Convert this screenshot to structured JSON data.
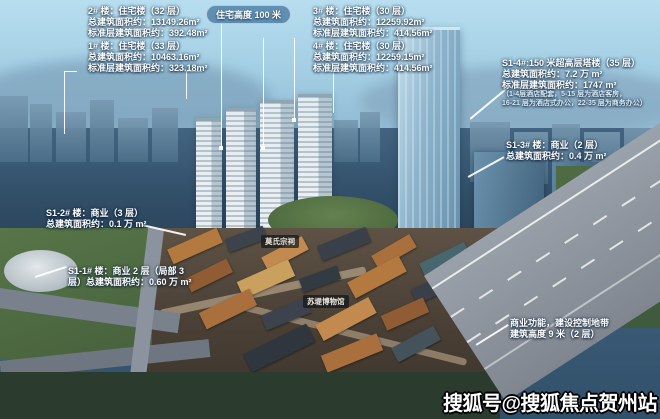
{
  "scene_title": "楼盘鸟瞰效果图（贺州）",
  "height_pill": {
    "text": "住宅高度 100 米"
  },
  "annotations": [
    {
      "id": "building-2",
      "lines": [
        "2# 楼：住宅楼（32 层）",
        "总建筑面积约：13149.26m²",
        "标准层建筑面积约：392.48m²"
      ]
    },
    {
      "id": "building-3",
      "lines": [
        "3# 楼：住宅楼（30 层）",
        "总建筑面积约：12259.92m²",
        "标准层建筑面积约：414.56m²"
      ]
    },
    {
      "id": "building-1",
      "lines": [
        "1# 楼：住宅楼（33 层）",
        "总建筑面积约：10463.16m²",
        "标准层建筑面积约：323.18m²"
      ]
    },
    {
      "id": "building-4",
      "lines": [
        "4# 楼：住宅楼（30 层）",
        "总建筑面积约：12259.15m²",
        "标准层建筑面积约：414.56m²"
      ]
    },
    {
      "id": "s1-4",
      "lines": [
        "S1-4#:150 米超高层塔楼（35 层）",
        "总建筑面积约：7.2 万 m²",
        "标准层建筑面积约：1747 m²",
        "（1-4层酒店配套，5-15 层为酒店客房，",
        "16-21 层为酒店式办公，22-35 层为商务办公）"
      ]
    },
    {
      "id": "s1-3",
      "lines": [
        "S1-3# 楼：商业（2 层）",
        "总建筑面积约：0.4 万 m²"
      ]
    },
    {
      "id": "s1-2",
      "lines": [
        "S1-2# 楼：商业（3 层）",
        "总建筑面积约：0.1 万 m²"
      ]
    },
    {
      "id": "s1-1",
      "lines": [
        "S1-1# 楼：商业 2 层（局部 3",
        "层）总建筑面积约：0.60 万 m²"
      ]
    },
    {
      "id": "commercial-zone",
      "lines": [
        "商业功能，建设控制地带",
        "建筑高度 9 米（2 层）"
      ]
    }
  ],
  "landmark_tags": [
    "莫氏宗祠",
    "苏堤博物馆"
  ],
  "watermark": {
    "text": "搜狐号@搜狐焦点贺州站"
  },
  "colors": {
    "label_text": "#ffffff",
    "pill_bg": "rgba(28,80,130,0.55)",
    "tag_bg": "rgba(18,22,30,0.72)",
    "sky": "#bce1f1",
    "city": "#31506a",
    "roof_orange": "#c28a4e"
  }
}
